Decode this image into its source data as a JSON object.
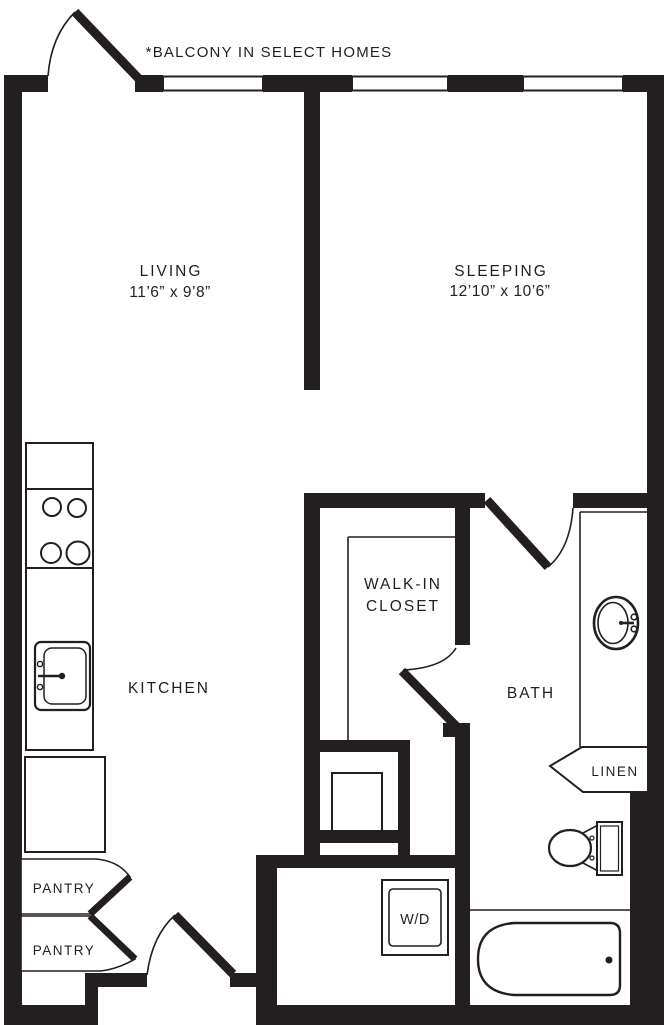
{
  "plan": {
    "balcony_note": "*BALCONY IN SELECT HOMES",
    "living": {
      "name": "LIVING",
      "dims": "11’6” x 9’8”"
    },
    "sleeping": {
      "name": "SLEEPING",
      "dims": "12’10” x 10’6”"
    },
    "kitchen": {
      "name": "KITCHEN"
    },
    "bath": {
      "name": "BATH"
    },
    "walk_in_closet": {
      "line1": "WALK-IN",
      "line2": "CLOSET"
    },
    "linen": {
      "name": "LINEN"
    },
    "pantry_upper": {
      "name": "PANTRY"
    },
    "pantry_lower": {
      "name": "PANTRY"
    },
    "washer_dryer": {
      "name": "W/D"
    }
  },
  "colors": {
    "wall": "#231f20",
    "line": "#231f20",
    "background": "#ffffff"
  }
}
